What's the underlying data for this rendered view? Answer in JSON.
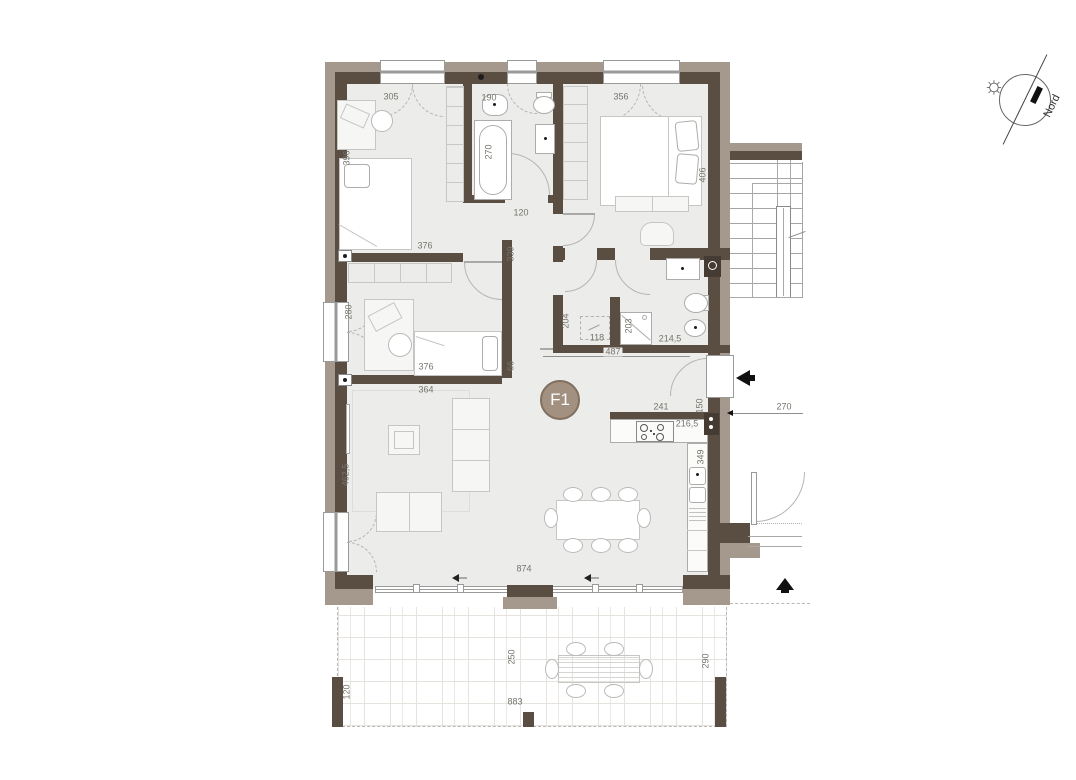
{
  "unit_label": "F1",
  "north_label": "Nord",
  "icons": {
    "sun": "☼"
  },
  "colors": {
    "wall_dark": "#5a4d42",
    "wall_light": "#a5988c",
    "floor": "#ececeb",
    "unit_badge": "#a29181"
  },
  "dims": [
    "305",
    "190",
    "356",
    "396",
    "270",
    "406",
    "120",
    "376",
    "339",
    "280",
    "204",
    "118",
    "203",
    "214,5",
    "487",
    "66",
    "376",
    "364",
    "462,5",
    "874",
    "241",
    "216,5",
    "150",
    "349",
    "270",
    "250",
    "290",
    "883",
    "120"
  ]
}
